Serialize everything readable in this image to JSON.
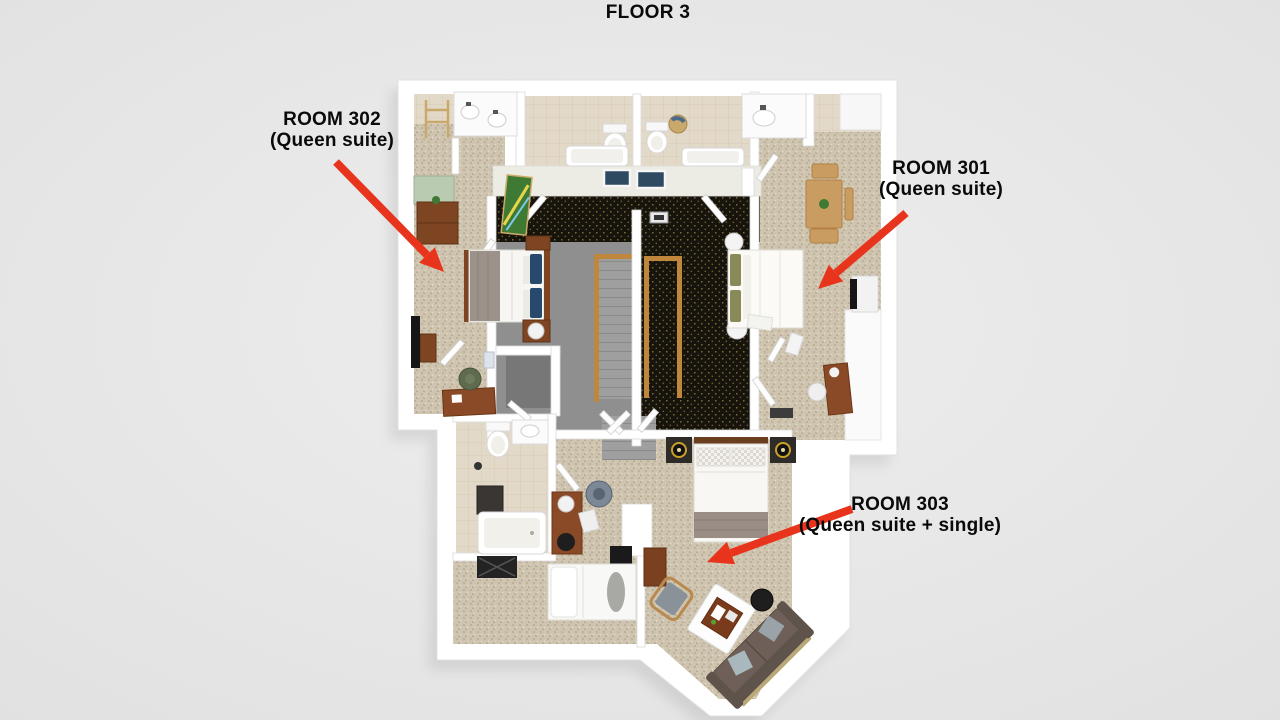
{
  "title": "FLOOR 3",
  "rooms": [
    {
      "id": "302",
      "label": "ROOM 302",
      "sublabel": "(Queen suite)"
    },
    {
      "id": "301",
      "label": "ROOM 301",
      "sublabel": "(Queen suite)"
    },
    {
      "id": "303",
      "label": "ROOM 303",
      "sublabel": "(Queen suite + single)"
    }
  ],
  "colors": {
    "background": "#E8E8E8",
    "label-text": "#0A0A0A",
    "arrow": "#E8341C",
    "wall": "#FFFFFF",
    "carpet": "#CFC4AF",
    "hall-carpet": "#17140D",
    "tile": "#E3D9C8",
    "stair-floor": "#8F8F8F",
    "wood-rail": "#BE873B"
  }
}
